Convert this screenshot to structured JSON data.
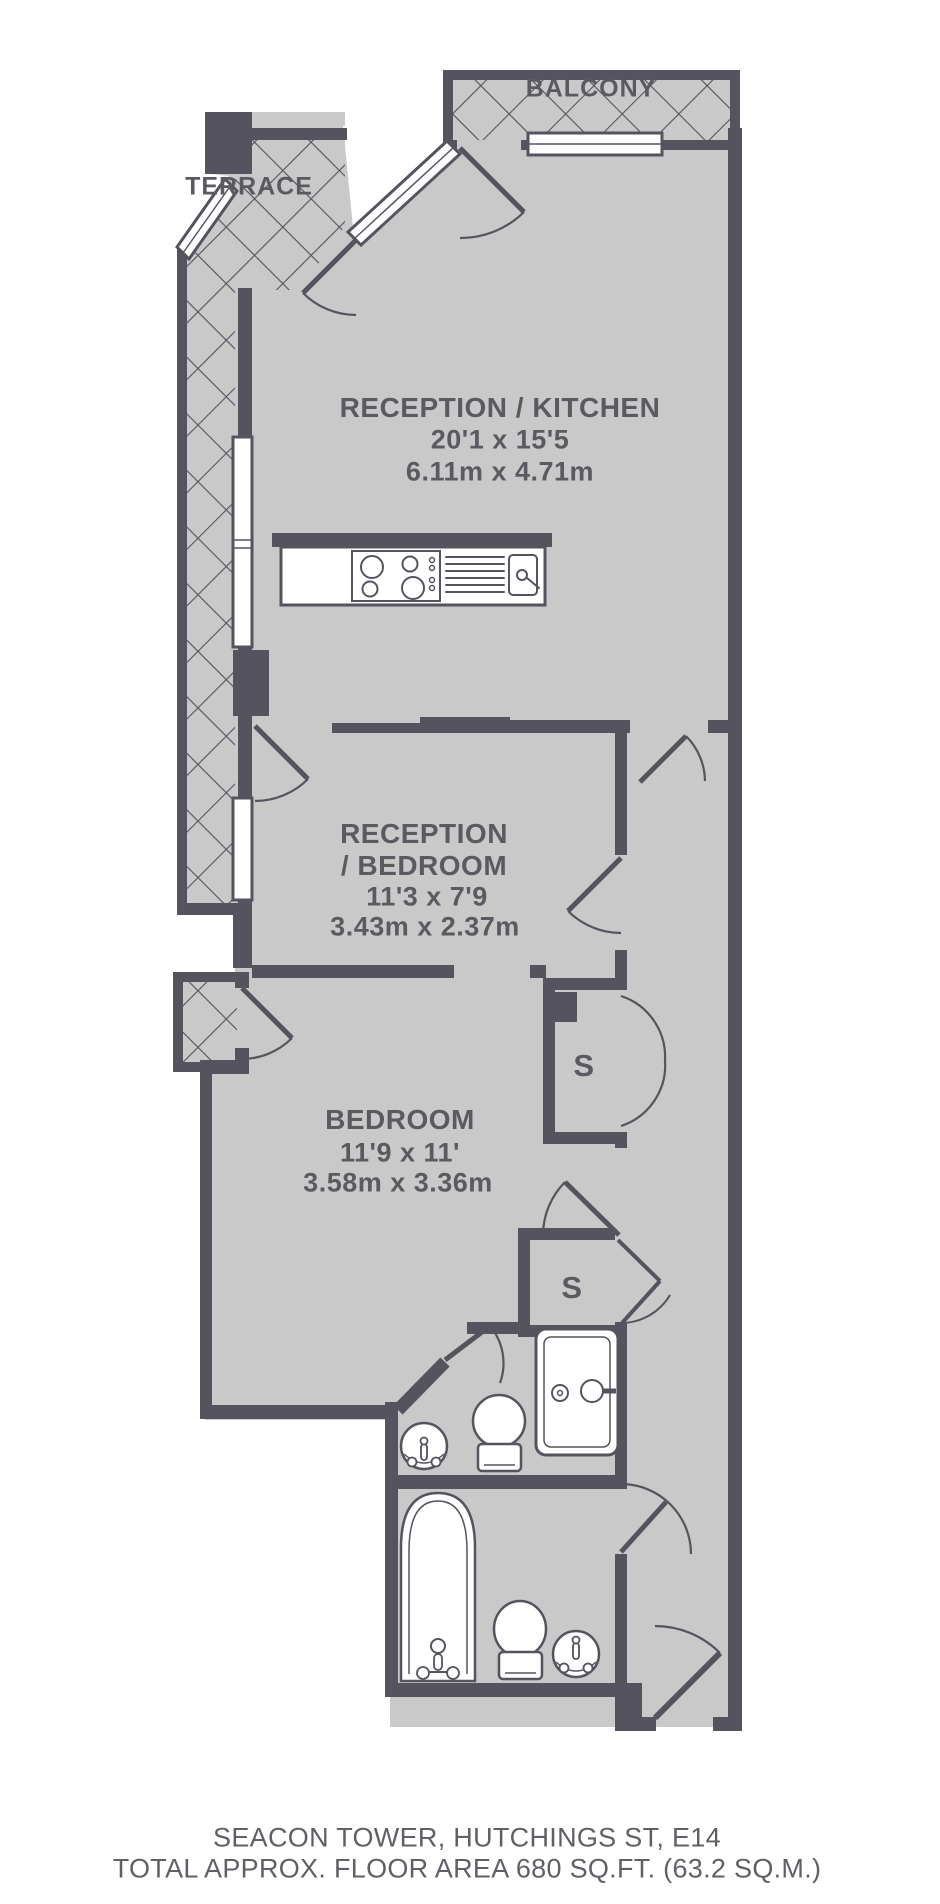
{
  "colors": {
    "wall": "#55545E",
    "floor": "#C9C9C9",
    "hatch_line": "#55545E",
    "text": "#5B5A61",
    "fixture_fill": "#FFFFFF"
  },
  "outdoor": {
    "balcony": "BALCONY",
    "terrace": "TERRACE"
  },
  "storage": {
    "s1": "S",
    "s2": "S"
  },
  "rooms": {
    "reception_kitchen": {
      "name": "RECEPTION / KITCHEN",
      "imperial": "20'1 x 15'5",
      "metric": "6.11m x 4.71m"
    },
    "reception_bedroom": {
      "name_line1": "RECEPTION",
      "name_line2": "/ BEDROOM",
      "imperial": "11'3 x 7'9",
      "metric": "3.43m x 2.37m"
    },
    "bedroom": {
      "name": "BEDROOM",
      "imperial": "11'9 x 11'",
      "metric": "3.58m x 3.36m"
    }
  },
  "footer": {
    "address": "SEACON TOWER,  HUTCHINGS ST, E14",
    "area": "TOTAL APPROX. FLOOR AREA 680 SQ.FT. (63.2 SQ.M.)"
  }
}
